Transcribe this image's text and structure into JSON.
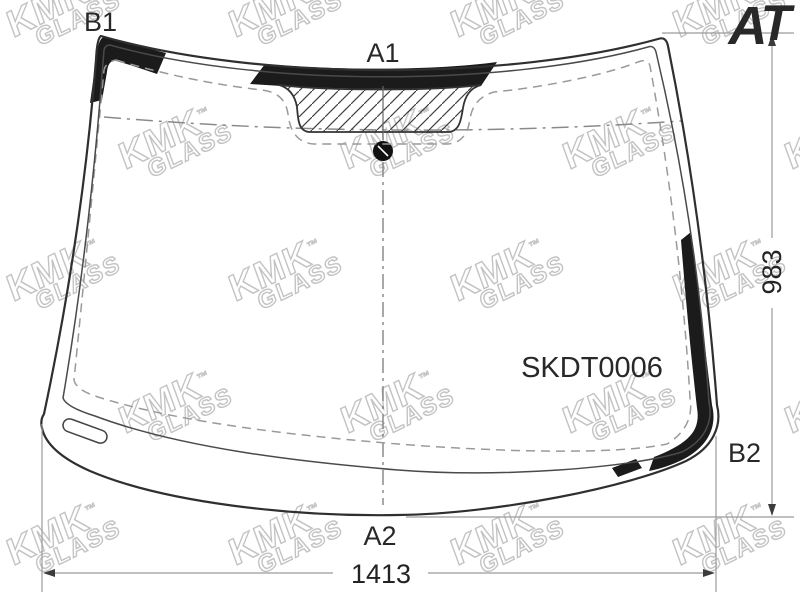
{
  "part_number": "SKDT0006",
  "zone_labels": {
    "b1": "B1",
    "a1": "A1",
    "a2": "A2",
    "b2": "B2"
  },
  "dimensions": {
    "height_mm": "983",
    "width_mm": "1413"
  },
  "logo": {
    "a": "A",
    "t": "T",
    "a_color": "#E8801F",
    "t_color": "#2A3BC8"
  },
  "watermark": {
    "brand": "KMK",
    "word": "GLASS",
    "tm": "™"
  },
  "colors": {
    "line": "#2f2f2f",
    "inner_line": "#4a4a4a",
    "band": "#1b1b1b",
    "dashed": "#9a9a9a",
    "dim": "#9b9b9b",
    "arrow": "#3c3c3c",
    "label": "#282828"
  }
}
